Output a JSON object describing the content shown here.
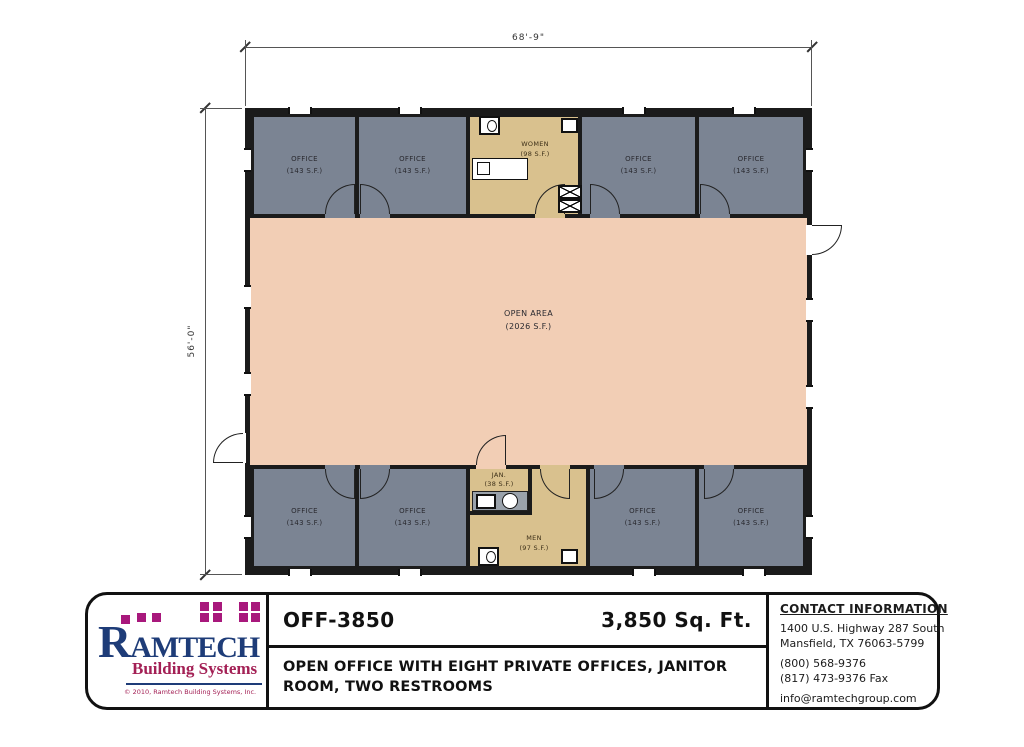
{
  "plan": {
    "dim_width": "68'-9\"",
    "dim_height": "56'-0\"",
    "office_name": "OFFICE",
    "office_area": "(143 S.F.)",
    "open_area_name": "OPEN AREA",
    "open_area_area": "(2026 S.F.)",
    "women_name": "WOMEN",
    "women_area": "(98 S.F.)",
    "men_name": "MEN",
    "men_area": "(97 S.F.)",
    "jan_name": "JAN.",
    "jan_area": "(38 S.F.)"
  },
  "title_block": {
    "model": "OFF-3850",
    "sqft": "3,850 Sq. Ft.",
    "description": "OPEN OFFICE WITH EIGHT PRIVATE OFFICES, JANITOR ROOM, TWO RESTROOMS",
    "contact": {
      "heading": "CONTACT INFORMATION",
      "address1": "1400 U.S. Highway 287 South",
      "address2": "Mansfield, TX  76063-5799",
      "phone": "(800) 568-9376",
      "fax": "(817) 473-9376 Fax",
      "email": "info@ramtechgroup.com"
    },
    "logo": {
      "name": "RAMTECH",
      "tagline": "Building Systems",
      "copyright": "© 2010, Ramtech Building Systems, Inc."
    }
  },
  "colors": {
    "office_fill": "#7b8493",
    "open_area_fill": "#f2ceb5",
    "restroom_fill": "#d9c18e",
    "wall": "#1b1b1b",
    "counter_gray": "#9aa2ab",
    "logo_navy": "#1e3c78",
    "logo_magenta": "#a8187c",
    "logo_crimson": "#a32055"
  }
}
